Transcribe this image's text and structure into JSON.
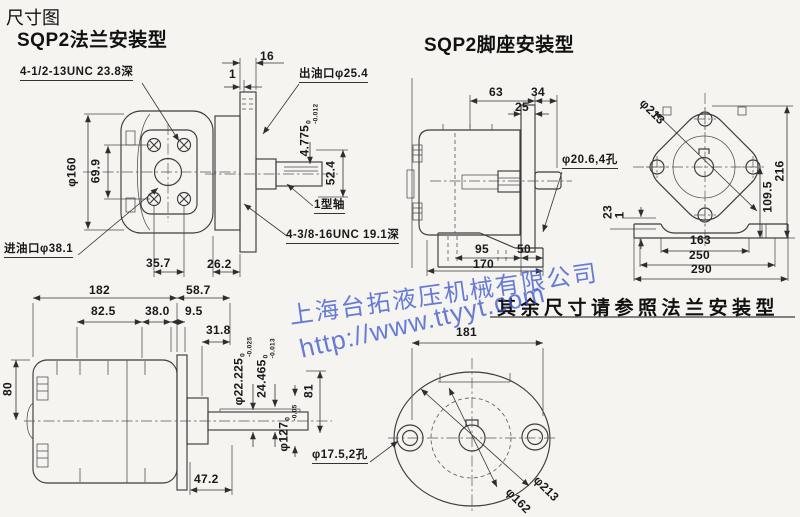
{
  "header": {
    "page_title": "尺寸图"
  },
  "flange": {
    "title": "SQP2法兰安装型",
    "front": {
      "thread": "4-1/2-13UNC 23.8深",
      "outer_dia": "φ160",
      "bolt_v": "69.9",
      "inlet": "进油口φ38.1",
      "d35_7": "35.7",
      "d26_2": "26.2"
    },
    "side": {
      "d16": "16",
      "d1": "1",
      "outlet": "出油口φ25.4",
      "key_h": "4.775",
      "key_h_tol_top": "0",
      "key_h_tol_bot": "-0.012",
      "d52_4": "52.4",
      "shaft_type": "1型轴",
      "thread": "4-3/8-16UNC 19.1深"
    },
    "profile": {
      "d182": "182",
      "d58_7": "58.7",
      "d82_5": "82.5",
      "d38_0": "38.0",
      "d9_5": "9.5",
      "d31_8": "31.8",
      "d80": "80",
      "shaft_dia": "φ22.225",
      "shaft_dia_tol_top": "0",
      "shaft_dia_tol_bot": "-0.025",
      "key_total": "24.465",
      "key_total_tol_top": "0",
      "key_total_tol_bot": "-0.013",
      "d81": "81",
      "pilot_dia": "φ127",
      "pilot_dia_tol_top": "0",
      "pilot_dia_tol_bot": "-0.05",
      "d47_2": "47.2"
    }
  },
  "foot": {
    "title": "SQP2脚座安装型",
    "note": "其余尺寸请参照法兰安装型",
    "side": {
      "d63": "63",
      "d34": "34",
      "d25": "25",
      "holes": "φ20.6,4孔",
      "d95": "95",
      "d50": "50",
      "d170": "170"
    },
    "front": {
      "dia": "φ213",
      "d216": "216",
      "d109_5": "109.5",
      "d23": "23",
      "d1": "1",
      "d163": "163",
      "d250": "250",
      "d290": "290"
    },
    "bottom": {
      "d181": "181",
      "holes": "φ17.5,2孔",
      "dia162": "φ162",
      "dia213": "φ213"
    }
  },
  "watermark": {
    "company": "上海台拓液压机械有限公司",
    "url": "http://www.ttyyt.com",
    "color": "#3e58cd"
  },
  "colors": {
    "background": "#f5f4f0",
    "line": "#3c3c3c",
    "text": "#191919"
  }
}
